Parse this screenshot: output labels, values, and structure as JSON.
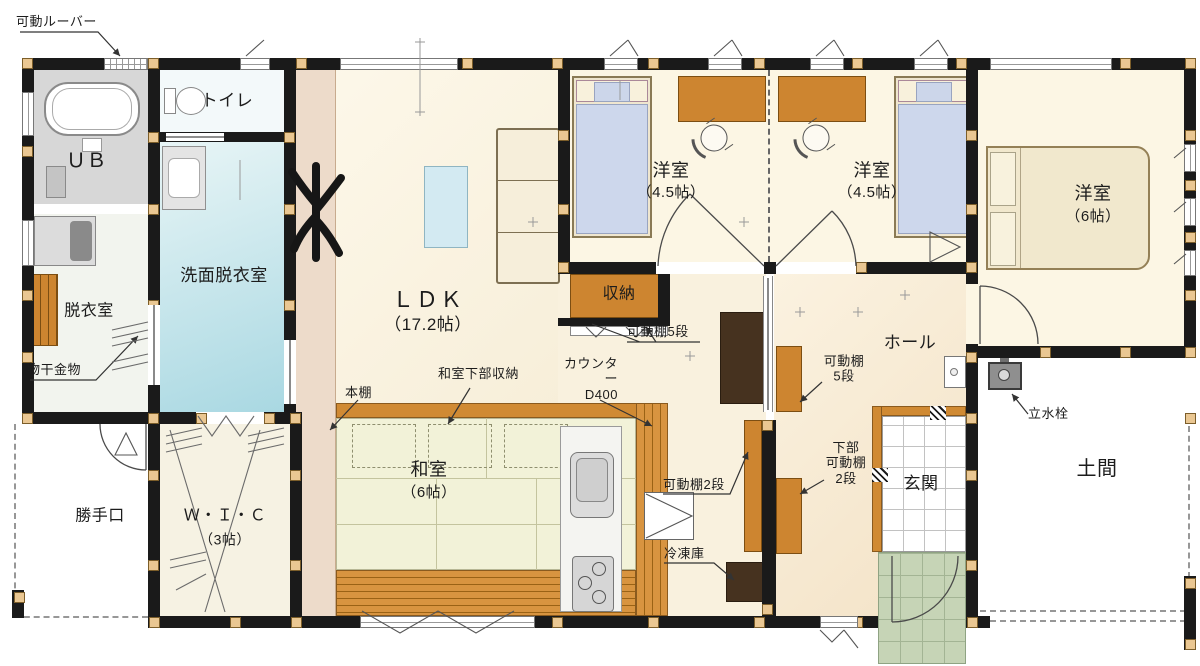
{
  "plan": {
    "rooms": {
      "ub": {
        "name": "ＵＢ"
      },
      "toilet": {
        "name": "トイレ"
      },
      "senmen": {
        "name": "洗面脱衣室"
      },
      "datsui": {
        "name": "脱衣室"
      },
      "ldk": {
        "name": "ＬＤＫ",
        "size": "（17.2帖）"
      },
      "youshitsu1": {
        "name": "洋室",
        "size": "（4.5帖）"
      },
      "youshitsu2": {
        "name": "洋室",
        "size": "（4.5帖）"
      },
      "youshitsu3": {
        "name": "洋室",
        "size": "（6帖）"
      },
      "washitsu": {
        "name": "和室",
        "size": "（6帖）"
      },
      "wic": {
        "name": "Ｗ・Ｉ・Ｃ",
        "size": "（3帖）"
      },
      "hall": {
        "name": "ホール"
      },
      "genkan": {
        "name": "玄関"
      },
      "doma": {
        "name": "土間"
      },
      "shuunou": {
        "name": "収納"
      },
      "katteguchi": {
        "name": "勝手口"
      }
    },
    "annotations": {
      "kadou_louver": "可動ルーバー",
      "monohoshi": "物干金物",
      "kadoudana5_shunou": "可動棚5段",
      "kadoudana5_hall": "可動棚\n5段",
      "kabu_kadoudana2": "下部\n可動棚\n2段",
      "kadoudana2": "可動棚2段",
      "reitouko": "冷凍庫",
      "hondana": "本棚",
      "washitsu_kabu": "和室下部収納",
      "counter": "カウンター\nD400",
      "tatemizu": "立水栓"
    },
    "colors": {
      "wall": "#1a1a1a",
      "post": "#eac792",
      "wood": "#d08a33",
      "shelf_wood": "#cd8530",
      "tatami": "#f2f2d8",
      "floor_cream": "#fbf5e3",
      "floor_hall": "#f6e8d1",
      "water_blue": "#a9d8e2",
      "porch_green": "#c6d4b6",
      "appliance_dark": "#46321f",
      "accent_band": "#eddbca"
    }
  }
}
